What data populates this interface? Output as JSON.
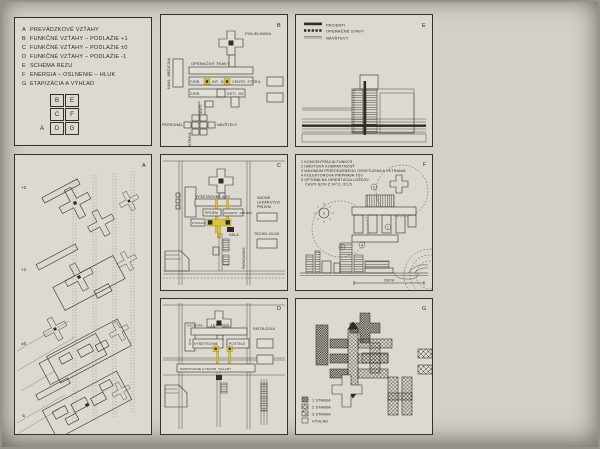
{
  "colors": {
    "paper": "#d3d0c7",
    "panel": "#dcd9d0",
    "ink": "#2f2d28",
    "highlight": "#d9c43c"
  },
  "index_panel": {
    "items": [
      {
        "key": "A",
        "label": "PREVÁDZKOVÉ VZŤAHY"
      },
      {
        "key": "B",
        "label": "FUNKČNÉ VZŤAHY – PODLAŽIE +1"
      },
      {
        "key": "C",
        "label": "FUNKČNÉ VZŤAHY – PODLAŽIE ±0"
      },
      {
        "key": "D",
        "label": "FUNKČNÉ VZŤAHY – PODLAŽIE -1"
      },
      {
        "key": "E",
        "label": "SCHÉMA REZU"
      },
      {
        "key": "F",
        "label": "ENERGIA – OSLNENIE – HLUK"
      },
      {
        "key": "G",
        "label": "ETAPIZÁCIA A VÝHĽAD"
      }
    ],
    "grid": {
      "r0c1": "B",
      "r0c2": "E",
      "r1c1": "C",
      "r1c2": "F",
      "r2c0": "A",
      "r2c1": "D",
      "r2c2": "G"
    }
  },
  "panel_b": {
    "letter": "B",
    "poliklinika": "POLIKLINIKA",
    "operacny_trakt": "OPERAČNÝ TRAKT",
    "nukl_medicina": "NUKL. MEDICÍNA",
    "chir_1": "CHIR.",
    "int_jis": "INT. JIS",
    "centr_steril": "CENTR. STERIL.",
    "chir_2": "CHIR.",
    "deti_jis": "DETI. JIS",
    "pacienti": "PACIENTI",
    "personal": "PERSONÁL",
    "navstevy": "NÁVŠTEVY",
    "strava": "STRAVA"
  },
  "panel_e": {
    "letter": "E",
    "legend": [
      {
        "label": "PACIENTI"
      },
      {
        "label": "OPERAČNÉ STAVY"
      },
      {
        "label": "NÁVŠTEVY"
      }
    ]
  },
  "panel_a": {
    "letter": "A",
    "levels": [
      "+2",
      "+1",
      "±0",
      "-1"
    ]
  },
  "panel_c": {
    "letter": "C",
    "vysetrovne_aro": "VYŠETROVNE ARO",
    "prijem": "PRÍJEM",
    "urgent_prijem": "URGENT. PRÍJEM",
    "sudne": "SÚDNE",
    "lekarstvo": "LEKÁRSTVO",
    "prijem_2": "PRÍJEM",
    "strava": "STRAVA",
    "sala": "SÁLA",
    "techn_blok": "TECHN. BLOK",
    "parkovanie": "PARKOVANIE"
  },
  "panel_f": {
    "letter": "F",
    "notes": [
      "1 KONCENTRÁCIA FUNKCIÍ",
      "2 HMOTOVÁ KOMPAKTNOSŤ",
      "3 MAXIMUM PRIRODZENÉHO OSVETLENIA A VETRANIA",
      "4 KOLEKTOROVÁ PRÍPRAVA TÚV",
      "5 OPTIMÁLNA ORIENTÁCIA LÔŽKOV.",
      "ČASTI SZ/V-Z 24°/J, 3/1,5"
    ],
    "markers": {
      "m1": "1",
      "m2": "2",
      "m3": "3",
      "m4": "4",
      "m5": "5"
    },
    "scale_label": "200 M"
  },
  "panel_d": {
    "letter": "D",
    "kuchyna": "KUCHYŇA",
    "lekaren": "LEKÁREŇ",
    "rtg": "RTG",
    "vysetrovne": "VYŠETROVNE",
    "postele": "POSTELE",
    "patologia": "PATOLÓGIA",
    "parkovanie_sklady": "PARKOVANIE A TECHN. SKLADY"
  },
  "panel_g": {
    "letter": "G",
    "legend": [
      {
        "label": "1 STAVBA"
      },
      {
        "label": "2 STAVBA"
      },
      {
        "label": "3 STAVBA"
      },
      {
        "label": "VÝHĽAD"
      }
    ]
  }
}
